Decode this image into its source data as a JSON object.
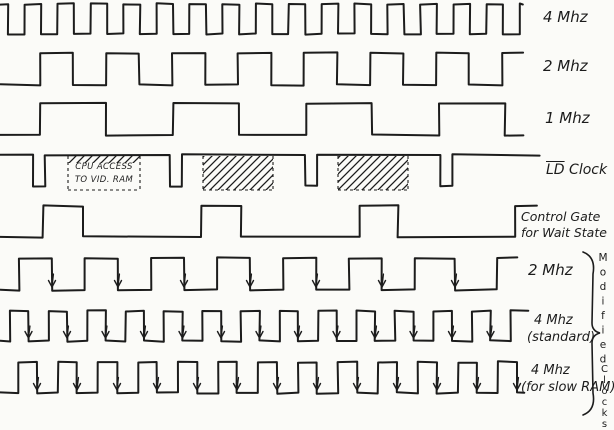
{
  "ink_color": "#1c1c1c",
  "paper_color": "#fbfbf8",
  "labels": {
    "row1": "4 Mhz",
    "row2": "2 Mhz",
    "row3": "1 Mhz",
    "row4_ld": "LD",
    "row4_rest": " Clock",
    "row5_line1": "Control Gate",
    "row5_line2": "for Wait State",
    "row6": "2 Mhz",
    "row7_line1": "4 Mhz",
    "row7_line2": "(standard)",
    "row8_line1": "4 Mhz",
    "row8_line2": "(for slow RAM)",
    "brace_word1": "Modified",
    "brace_word2": "Clocks",
    "cpu_box_line1": "CPU ACCESS",
    "cpu_box_line2": "TO VID. RAM"
  },
  "chart_data": {
    "type": "timing-diagram",
    "description": "Hand-drawn clock timing diagram: system clocks, LD clock with CPU access windows to video RAM, wait-state control gate, and modified clocks with falling-edge arrows.",
    "waveforms": [
      {
        "name": "clock-4mhz",
        "label": "4 Mhz",
        "y_high": 4,
        "y_low": 34,
        "start": "high",
        "x_start": 0,
        "x_end": 523,
        "edges": [
          8,
          24.5,
          41,
          57.5,
          74,
          90.5,
          107,
          123.5,
          140,
          156.5,
          173,
          189.5,
          206,
          222.5,
          239,
          255.5,
          272,
          288.5,
          305,
          321.5,
          338,
          354.5,
          371,
          387.5,
          404,
          420.5,
          437,
          453.5,
          470,
          486.5,
          503,
          519.5
        ],
        "arrows": []
      },
      {
        "name": "clock-2mhz",
        "label": "2 Mhz",
        "y_high": 53,
        "y_low": 85,
        "start": "low",
        "x_start": 0,
        "x_end": 523,
        "edges": [
          40,
          73,
          106,
          139,
          172,
          205,
          238,
          271,
          304,
          337,
          370,
          403,
          436,
          469,
          502
        ],
        "arrows": []
      },
      {
        "name": "clock-1mhz",
        "label": "1 Mhz",
        "y_high": 103,
        "y_low": 135,
        "start": "low",
        "x_start": 0,
        "x_end": 523,
        "edges": [
          40,
          106,
          173,
          239,
          306,
          372,
          439,
          505
        ],
        "arrows": []
      },
      {
        "name": "ld-clock",
        "label": "LD Clock",
        "y_high": 155,
        "y_low": 186,
        "start": "high",
        "x_start": 0,
        "x_end": 540,
        "edges": [
          33,
          45,
          170,
          182,
          305,
          317,
          440,
          452
        ],
        "arrows": []
      },
      {
        "name": "control-gate",
        "label": "Control Gate for Wait State",
        "y_high": 206,
        "y_low": 237,
        "start": "low",
        "x_start": 0,
        "x_end": 537,
        "edges": [
          43,
          83,
          201,
          241,
          360,
          398,
          515
        ],
        "arrows": []
      },
      {
        "name": "modified-2mhz",
        "label": "2 Mhz (modified)",
        "y_high": 258,
        "y_low": 290,
        "start": "low",
        "x_start": 0,
        "x_end": 517,
        "edges": [
          19,
          52,
          85,
          118,
          151,
          184,
          217,
          250,
          283,
          316,
          349,
          382,
          415,
          455,
          497
        ],
        "arrows": [
          52,
          118,
          184,
          250,
          316,
          382,
          455
        ]
      },
      {
        "name": "modified-4mhz-standard",
        "label": "4 Mhz (standard)",
        "y_high": 311,
        "y_low": 341,
        "start": "low",
        "x_start": 0,
        "x_end": 528,
        "edges": [
          10,
          28.5,
          48.5,
          67,
          87,
          105.5,
          125.5,
          144,
          164,
          182.5,
          202.5,
          221,
          241,
          259.5,
          279.5,
          298,
          318,
          336.5,
          356.5,
          375,
          395,
          413.5,
          433.5,
          452,
          472,
          490.5,
          510.5
        ],
        "arrows": [
          28.5,
          67,
          105.5,
          144,
          182.5,
          221,
          259.5,
          298,
          336.5,
          375,
          413.5,
          452,
          490.5
        ]
      },
      {
        "name": "modified-4mhz-slow-ram",
        "label": "4 Mhz (for slow RAM)",
        "y_high": 362,
        "y_low": 393,
        "start": "low",
        "x_start": 0,
        "x_end": 524,
        "edges": [
          18,
          37,
          58,
          77,
          98,
          117,
          138,
          157,
          178,
          197,
          218,
          237,
          258,
          277,
          298,
          317,
          338,
          357,
          378,
          397,
          418,
          437,
          458,
          477,
          498,
          517
        ],
        "arrows": [
          37,
          77,
          117,
          157,
          197,
          237,
          277,
          317,
          357,
          397,
          437,
          477,
          517
        ]
      }
    ],
    "access_windows": [
      {
        "name": "cpu-access-window",
        "x": 68,
        "y": 156,
        "w": 72,
        "h": 34,
        "style": "text-top-hatch",
        "text": "CPU ACCESS TO VID. RAM"
      },
      {
        "name": "hatched-window-2",
        "x": 203,
        "y": 156,
        "w": 70,
        "h": 34,
        "style": "hatch",
        "text": ""
      },
      {
        "name": "hatched-window-3",
        "x": 338,
        "y": 156,
        "w": 70,
        "h": 34,
        "style": "hatch",
        "text": ""
      }
    ],
    "brace": {
      "x": 589,
      "y_top": 252,
      "y_mid": 333,
      "y_bottom": 415,
      "group_label": "Modified Clocks"
    }
  }
}
